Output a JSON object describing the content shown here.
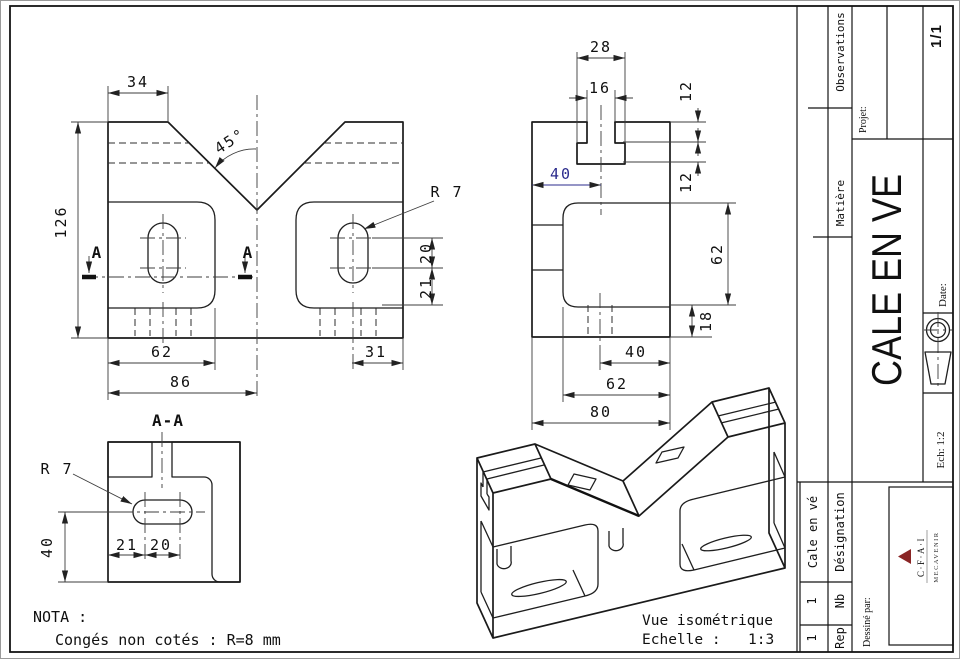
{
  "front_view": {
    "dim_34": "34",
    "dim_45": "45°",
    "dim_126": "126",
    "dim_62": "62",
    "dim_86": "86",
    "dim_31": "31",
    "dim_20": "20",
    "dim_21": "21",
    "radius": "R 7",
    "section_letter": "A"
  },
  "side_view": {
    "dim_28": "28",
    "dim_16": "16",
    "dim_12a": "12",
    "dim_12b": "12",
    "dim_40": "40",
    "dim_62_right": "62",
    "dim_18": "18",
    "dim_40_bottom": "40",
    "dim_62_bottom": "62",
    "dim_80": "80"
  },
  "section_view": {
    "title": "A-A",
    "radius": "R 7",
    "dim_40": "40",
    "dim_21": "21",
    "dim_20": "20"
  },
  "notes": {
    "nota": "NOTA :",
    "line2": "Congés non cotés : R=8 mm"
  },
  "iso_view": {
    "caption": "Vue isométrique",
    "scale_label": "Echelle :",
    "scale_value": "1:3"
  },
  "title_block": {
    "observations": "Observations",
    "projet": "Projet:",
    "page_num": "1/1",
    "matiere": "Matière",
    "part_title": "CALE EN VE",
    "date": "Date:",
    "scale": "Ech: 1:2",
    "designation_label": "Désignation",
    "designation_value": "Cale en vé",
    "nb_label": "Nb",
    "nb_value": "1",
    "rep_label": "Rep",
    "rep_value": "1",
    "drawn_by": "Dessiné par:",
    "logo_top": "C·F·A·I",
    "logo_bottom": "MECAVENIR"
  },
  "colors": {
    "accent_blue": "#2b2b8c",
    "logo_red": "#8a2525",
    "line": "#1a1a1a"
  }
}
